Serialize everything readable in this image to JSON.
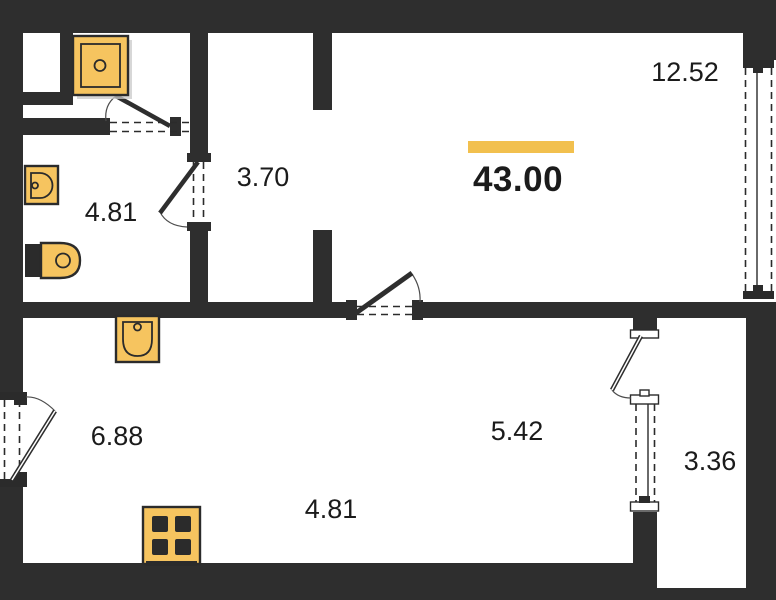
{
  "areas": {
    "total": "43.00",
    "living": "12.52",
    "hallway": "3.70",
    "bathroom": "4.81",
    "kitchen": "6.88",
    "room_center": "5.42",
    "room_lower": "4.81",
    "balcony": "3.36"
  },
  "colors": {
    "wall": "#2E2E2E",
    "line": "#2B2B2B",
    "fixture_fill": "#F6C45F",
    "accent_bar": "#F2C04E",
    "text": "#1B1B1B",
    "shadow": "#C9C9C9",
    "background": "#FFFFFF"
  },
  "fixtures": [
    "shower-tray-icon",
    "bathroom-sink-icon",
    "toilet-icon",
    "kitchen-sink-icon",
    "stove-icon"
  ]
}
